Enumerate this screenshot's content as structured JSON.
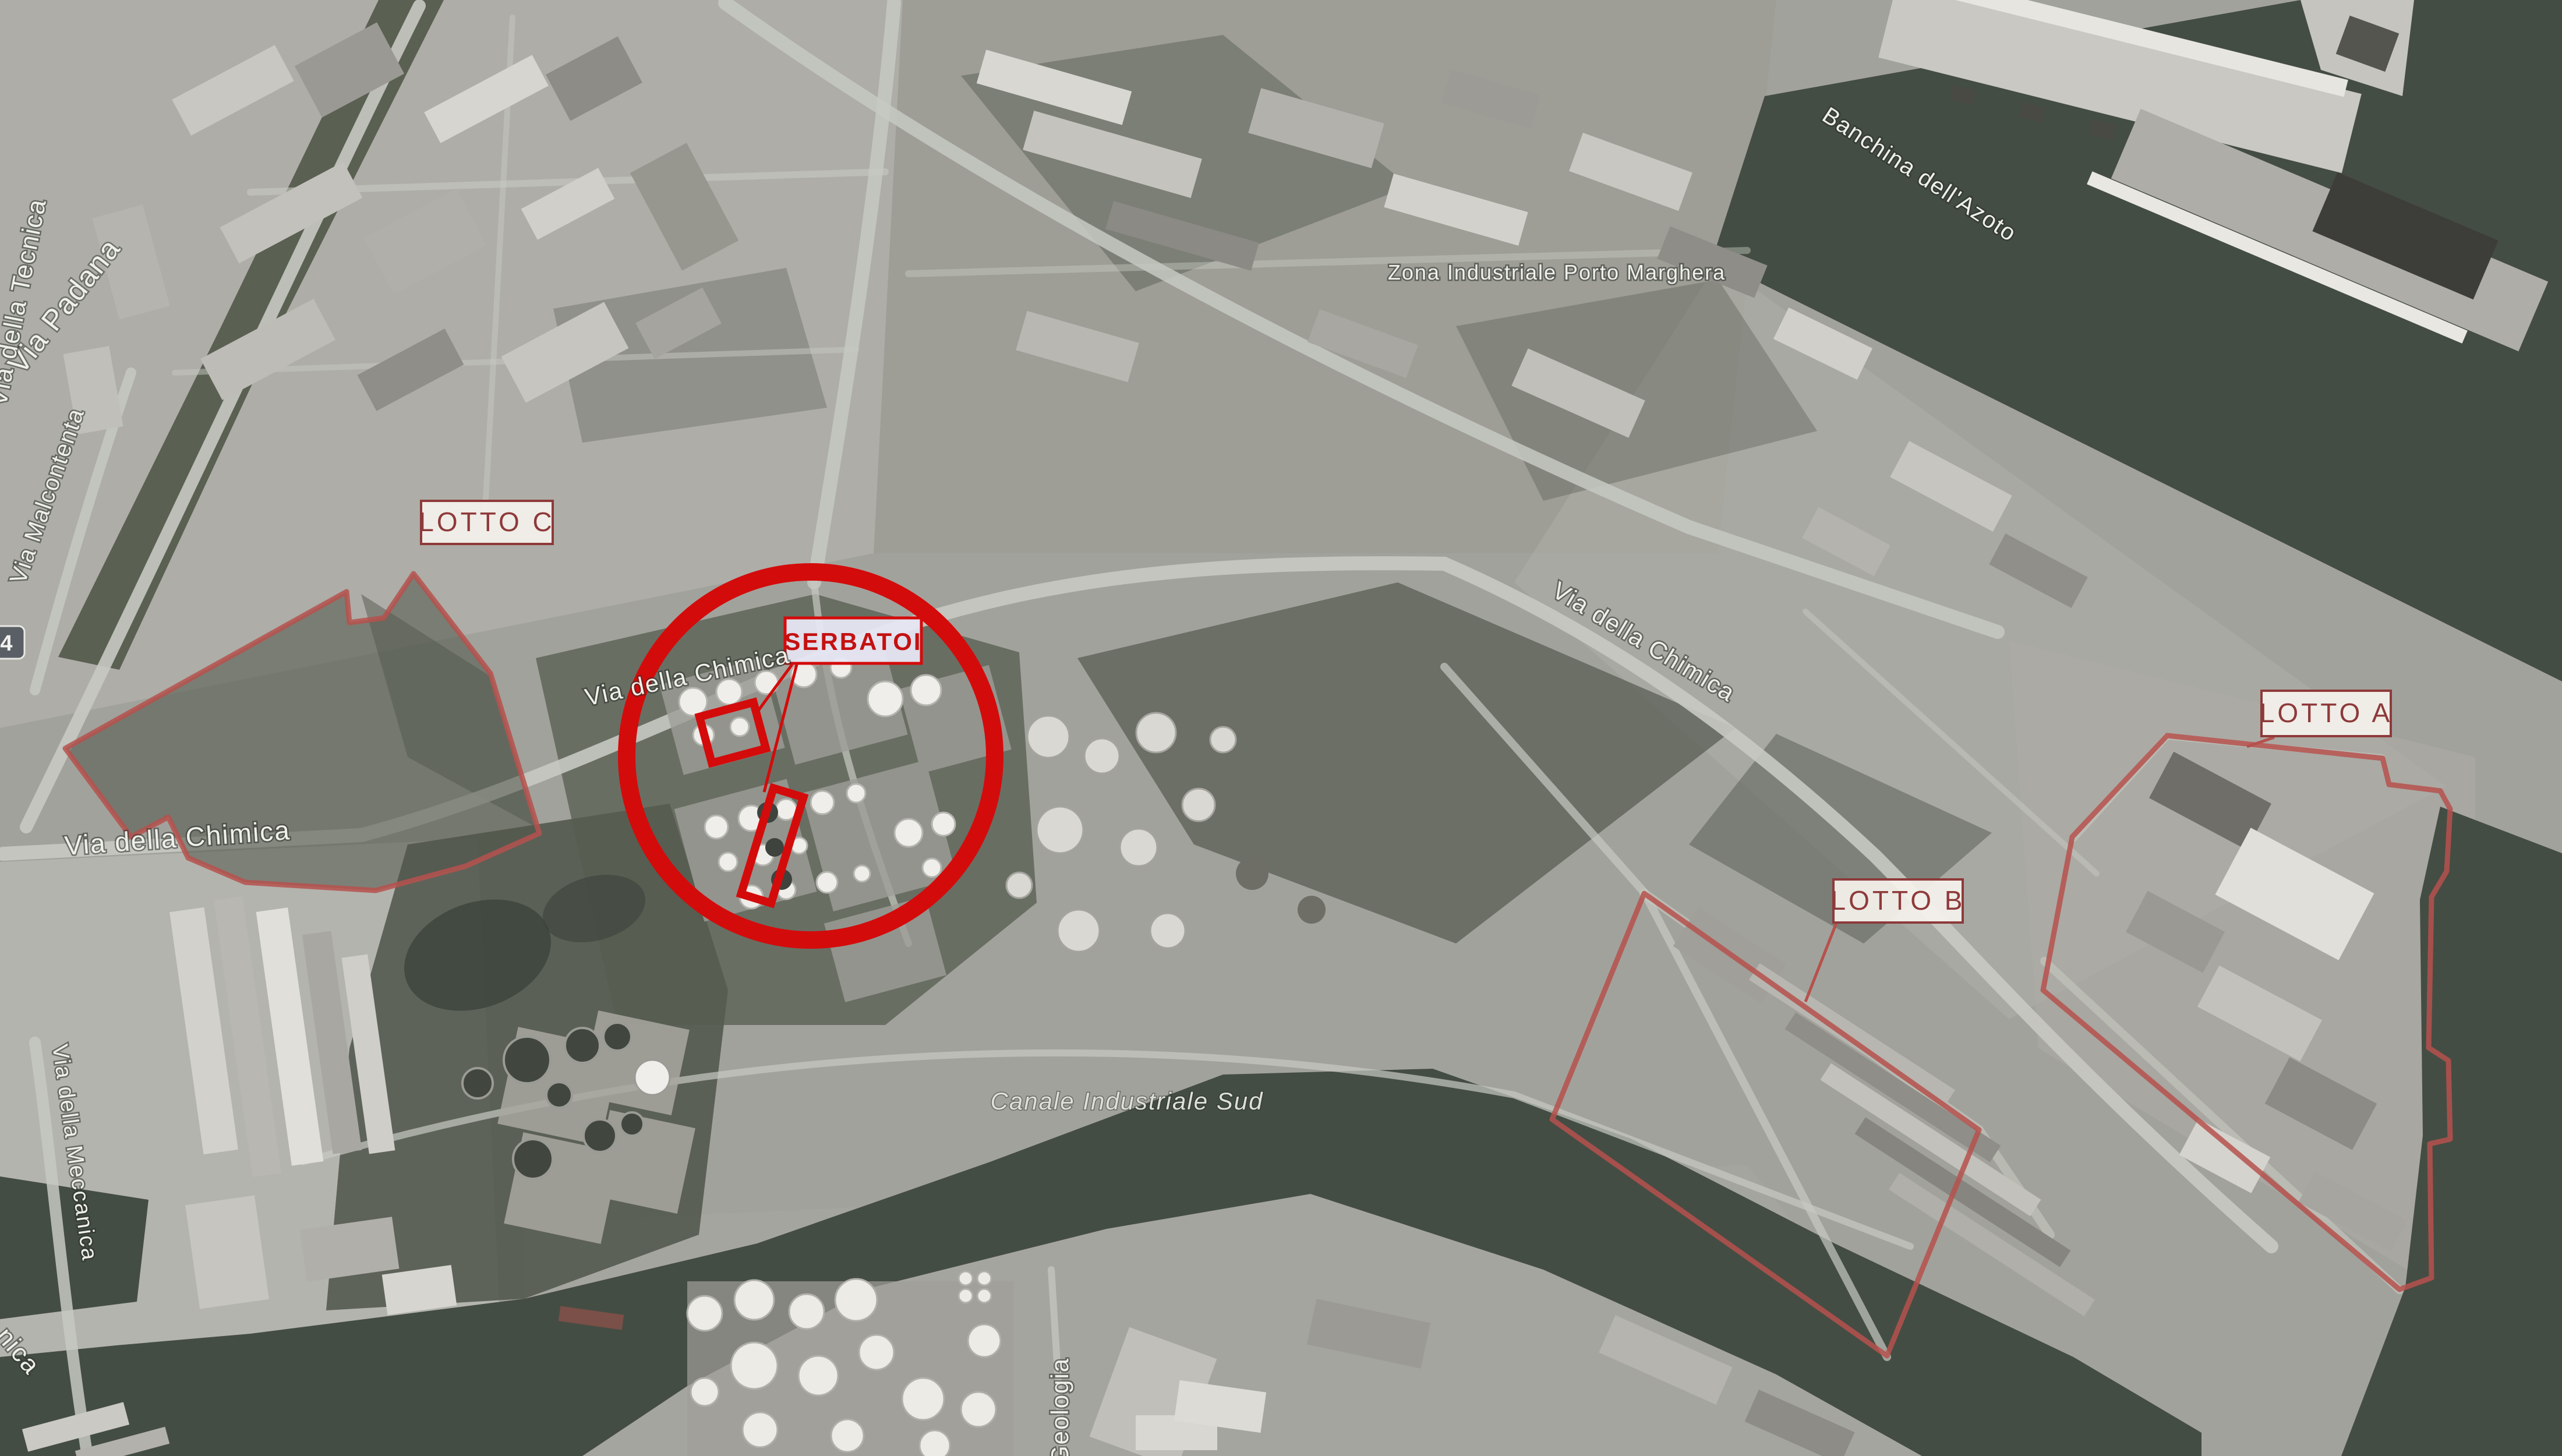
{
  "title": "Annotated satellite view - Zona Industriale Porto Marghera with Lotto A, B, C and Serbatoi areas",
  "map": {
    "region_label": "Zona Industriale Porto Marghera",
    "water_label": "Canale Industriale Sud",
    "quay_label": "Banchina dell'Azoto",
    "areas": {
      "lotto_a": {
        "label": "LOTTO A"
      },
      "lotto_b": {
        "label": "LOTTO B"
      },
      "lotto_c": {
        "label": "LOTTO C"
      },
      "serbatoi": {
        "label": "SERBATOI"
      }
    },
    "street_labels": {
      "via_padana": {
        "text": "Via Padana"
      },
      "via_della_tecnica": {
        "text": "Via della Tecnica"
      },
      "via_malcontenta": {
        "text": "Via Malcontenta"
      },
      "via_della_chimica_west": {
        "text": "Via della Chimica"
      },
      "via_della_chimica_circle": {
        "text": "Via della Chimica"
      },
      "via_della_chimica_east": {
        "text": "Via della Chimica"
      },
      "via_della_meccanica": {
        "text": "Via della Meccanica"
      },
      "geologia": {
        "text": "Geologia"
      },
      "street_fragment_sw": {
        "text": "nica"
      },
      "road_shield": {
        "text": "4"
      }
    },
    "colors": {
      "annotation_red": "#d40b0b",
      "outline_red": "#b6514d",
      "label_text_red": "#8e3a3a",
      "serbatoi_text_red": "#c41111",
      "label_box_fill": "#f5f2ed",
      "serbatoi_box_fill": "#e7e6f3",
      "street_label_white": "#f0f0ea",
      "water": "#444d43",
      "land": "#a2a29c"
    }
  }
}
